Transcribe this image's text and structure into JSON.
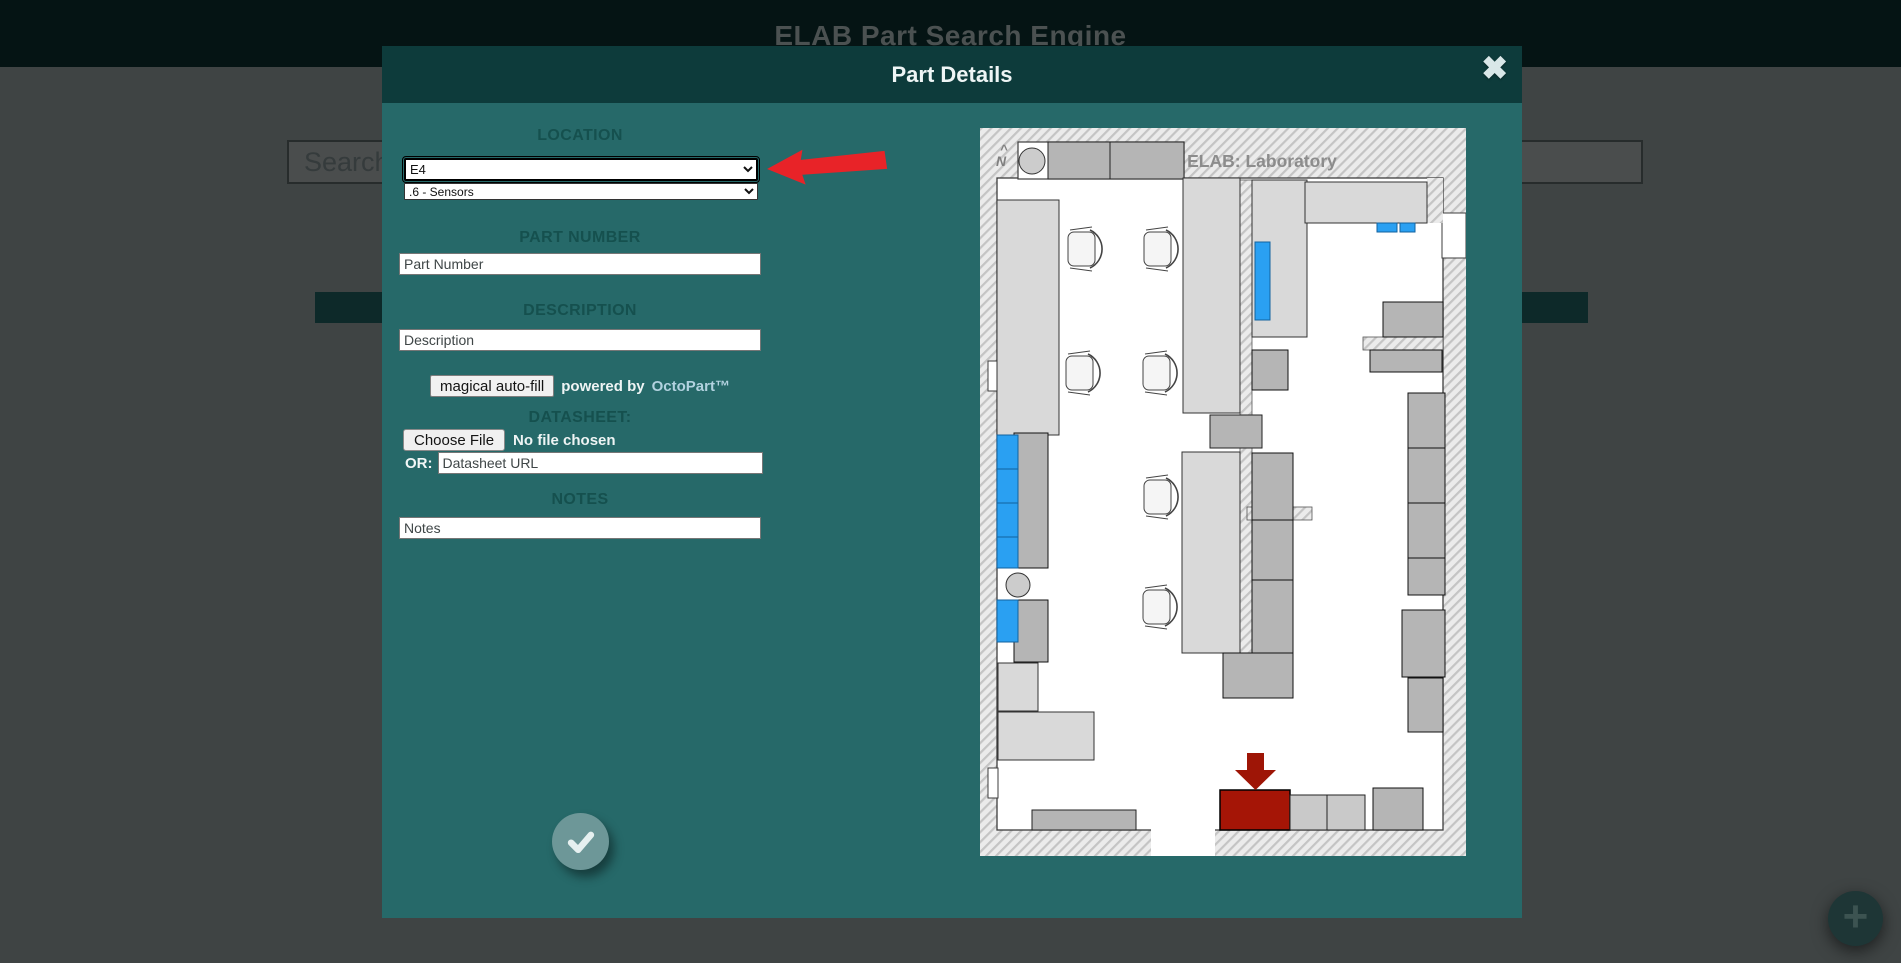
{
  "header": {
    "title": "ELAB Part Search Engine"
  },
  "background": {
    "search_value": "Search"
  },
  "fab": {
    "plus_icon": "+"
  },
  "modal": {
    "title": "Part Details",
    "close_icon": "✖",
    "location": {
      "label": "LOCATION",
      "area_value": "E4",
      "shelf_value": ".6 - Sensors"
    },
    "part_number": {
      "label": "PART NUMBER",
      "placeholder": "Part Number",
      "value": ""
    },
    "description": {
      "label": "DESCRIPTION",
      "placeholder": "Description",
      "value": ""
    },
    "autofill": {
      "button": "magical auto-fill",
      "powered_by": "powered by",
      "provider": "OctoPart™"
    },
    "datasheet": {
      "label": "DATASHEET:",
      "choose_file": "Choose File",
      "file_status": "No file chosen",
      "or": "OR:",
      "url_placeholder": "Datasheet URL",
      "url_value": ""
    },
    "notes": {
      "label": "NOTES",
      "placeholder": "Notes",
      "value": ""
    }
  },
  "map": {
    "title": "ELAB: Laboratory",
    "north_caret": "^",
    "north_label": "N"
  },
  "colors": {
    "page_dim_bg": "#3f4444",
    "modal_bg": "#266969",
    "modal_header": "#0d3b3b",
    "annotation_red": "#e82328",
    "selected_location_red": "#a51506",
    "highlight_blue": "#2aa0f2",
    "furniture_gray": "#b5b5b5",
    "bench_gray": "#d9d9d9"
  }
}
